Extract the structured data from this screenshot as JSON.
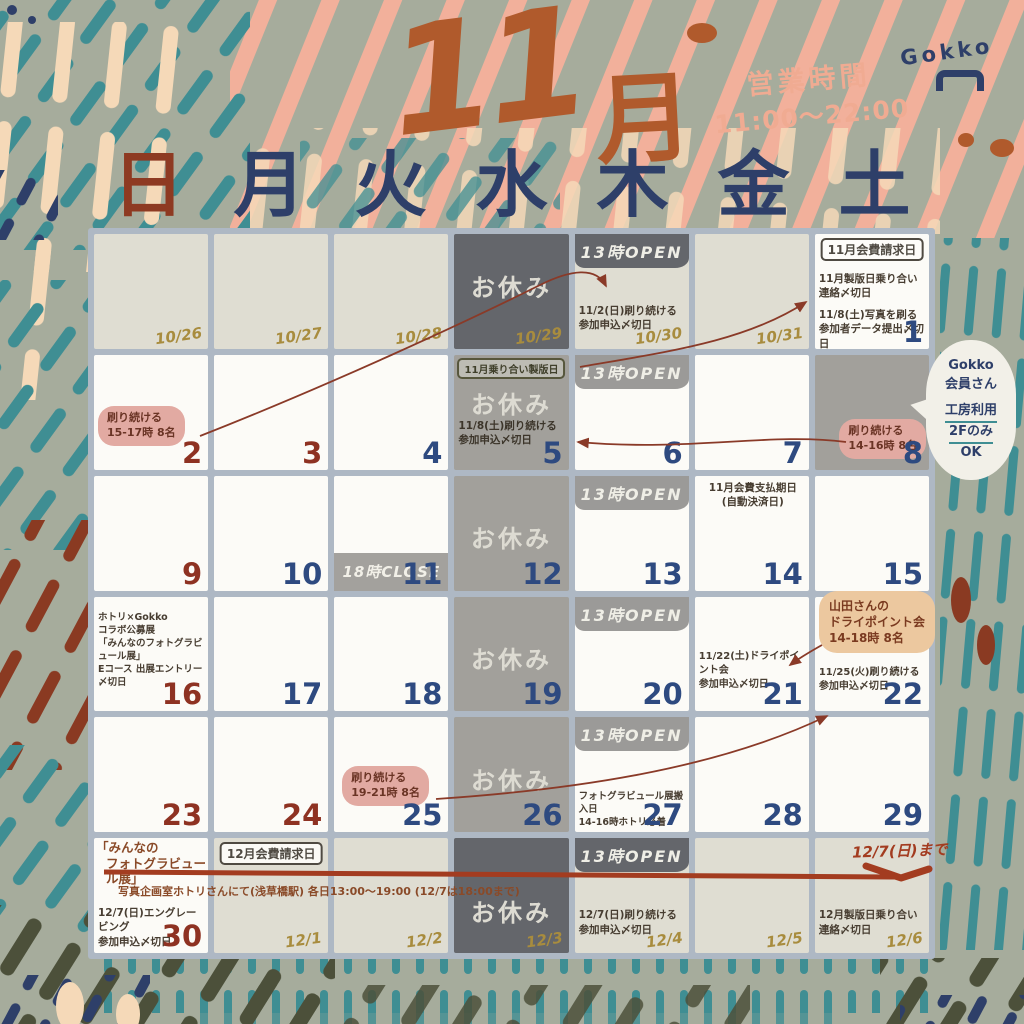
{
  "header": {
    "month_title_num": "11",
    "month_title_unit": "月",
    "hours_label": "営業時間",
    "hours_value": "11:00〜22:00",
    "logo_text": "Gokko"
  },
  "weekdays": [
    "日",
    "月",
    "火",
    "水",
    "木",
    "金",
    "土"
  ],
  "speech_bubble": {
    "lines": [
      "Gokko",
      "会員さん",
      "工房利用",
      "2Fのみ",
      "OK"
    ]
  },
  "exhibition": {
    "venue_note": "写真企画室ホトリさんにて(浅草橋駅) 各日13:00〜19:00 (12/7は18:00まで)",
    "until_label": "12/7(日)まで"
  },
  "colors": {
    "background": "#a6ac9c",
    "title_rust": "#b05a2c",
    "navy": "#2e3f69",
    "holiday_red": "#8e3a22",
    "teal": "#3f8e93",
    "peach": "#f2b09b",
    "cream": "#f5d9b8",
    "olive_date": "#a88c3e",
    "cell_white": "#fcfbf7",
    "cell_beige": "#dfddd2",
    "cell_gray": "#a2a09b",
    "cell_dark": "#64666b",
    "grid_border": "#aeb8c4",
    "bubble_pink": "#e2aaa2",
    "bubble_orange": "#ecc89f",
    "timeline_red": "#a33c20"
  },
  "calendar": {
    "cells": [
      {
        "date": "10/26",
        "num": "olive",
        "bg": "beige"
      },
      {
        "date": "10/27",
        "num": "olive",
        "bg": "beige"
      },
      {
        "date": "10/28",
        "num": "olive",
        "bg": "beige"
      },
      {
        "date": "10/29",
        "num": "olive",
        "bg": "dark",
        "closed": "お休み"
      },
      {
        "date": "10/30",
        "num": "olive",
        "bg": "beige",
        "header": "13時OPEN",
        "header_style": "dark",
        "notes": [
          "11/2(日)刷り続ける",
          "参加申込〆切日"
        ]
      },
      {
        "date": "10/31",
        "num": "olive",
        "bg": "beige"
      },
      {
        "date": "1",
        "num": "navy",
        "bg": "white",
        "box": "11月会費請求日",
        "notes": [
          "11月製版日乗り合い",
          "連絡〆切日",
          "",
          "11/8(土)写真を刷る",
          "参加者データ提出〆切日"
        ]
      },
      {
        "date": "2",
        "num": "red",
        "bg": "white",
        "bubble": {
          "style": "pink",
          "lines": [
            "刷り続ける",
            "15-17時 8名"
          ]
        }
      },
      {
        "date": "3",
        "num": "red",
        "bg": "white"
      },
      {
        "date": "4",
        "num": "navy",
        "bg": "white"
      },
      {
        "date": "5",
        "num": "navy",
        "bg": "gray",
        "box": "11月乗り合い製版日",
        "closed": "お休み",
        "notes": [
          "11/8(土)刷り続ける",
          "参加申込〆切日"
        ]
      },
      {
        "date": "6",
        "num": "navy",
        "bg": "white",
        "header": "13時OPEN",
        "header_style": "gray"
      },
      {
        "date": "7",
        "num": "navy",
        "bg": "white"
      },
      {
        "date": "8",
        "num": "navy",
        "bg": "gray",
        "bubble": {
          "style": "pink",
          "lines": [
            "刷り続ける",
            "14-16時 8名"
          ]
        }
      },
      {
        "date": "9",
        "num": "red",
        "bg": "white"
      },
      {
        "date": "10",
        "num": "navy",
        "bg": "white"
      },
      {
        "date": "11",
        "num": "navy",
        "bg": "white",
        "footer": "18時CLOSE"
      },
      {
        "date": "12",
        "num": "navy",
        "bg": "gray",
        "closed": "お休み"
      },
      {
        "date": "13",
        "num": "navy",
        "bg": "white",
        "header": "13時OPEN",
        "header_style": "gray"
      },
      {
        "date": "14",
        "num": "navy",
        "bg": "white",
        "notes": [
          "11月会費支払期日",
          "(自動決済日)"
        ]
      },
      {
        "date": "15",
        "num": "navy",
        "bg": "white"
      },
      {
        "date": "16",
        "num": "red",
        "bg": "white",
        "notes": [
          "ホトリ×Gokko",
          "コラボ公募展",
          "「みんなのフォトグラビュール展」",
          "Eコース 出展エントリー〆切日"
        ]
      },
      {
        "date": "17",
        "num": "navy",
        "bg": "white"
      },
      {
        "date": "18",
        "num": "navy",
        "bg": "white"
      },
      {
        "date": "19",
        "num": "navy",
        "bg": "gray",
        "closed": "お休み"
      },
      {
        "date": "20",
        "num": "navy",
        "bg": "white",
        "header": "13時OPEN",
        "header_style": "gray"
      },
      {
        "date": "21",
        "num": "navy",
        "bg": "white",
        "notes": [
          "11/22(土)ドライポイント会",
          "参加申込〆切日"
        ]
      },
      {
        "date": "22",
        "num": "navy",
        "bg": "white",
        "bubble": {
          "style": "orange",
          "lines": [
            "山田さんの",
            "ドライポイント会",
            "14-18時 8名"
          ]
        },
        "notes": [
          "11/25(火)刷り続ける",
          "参加申込〆切日"
        ]
      },
      {
        "date": "23",
        "num": "red",
        "bg": "white"
      },
      {
        "date": "24",
        "num": "red",
        "bg": "white"
      },
      {
        "date": "25",
        "num": "navy",
        "bg": "white",
        "bubble": {
          "style": "pink",
          "lines": [
            "刷り続ける",
            "19-21時 8名"
          ]
        }
      },
      {
        "date": "26",
        "num": "navy",
        "bg": "gray",
        "closed": "お休み"
      },
      {
        "date": "27",
        "num": "navy",
        "bg": "white",
        "header": "13時OPEN",
        "header_style": "gray",
        "notes": [
          "フォトグラビュール展搬入日",
          "14-16時ホトリ必着"
        ]
      },
      {
        "date": "28",
        "num": "navy",
        "bg": "white"
      },
      {
        "date": "29",
        "num": "navy",
        "bg": "white"
      },
      {
        "date": "30",
        "num": "red",
        "bg": "white",
        "top_note": [
          "「みんなの",
          "フォトグラビュール展」"
        ],
        "notes": [
          "12/7(日)エングレービング",
          "参加申込〆切日"
        ]
      },
      {
        "date": "12/1",
        "num": "olive",
        "bg": "beige",
        "box": "12月会費請求日"
      },
      {
        "date": "12/2",
        "num": "olive",
        "bg": "beige"
      },
      {
        "date": "12/3",
        "num": "olive",
        "bg": "dark",
        "closed": "お休み"
      },
      {
        "date": "12/4",
        "num": "olive",
        "bg": "beige",
        "header": "13時OPEN",
        "header_style": "dark",
        "notes": [
          "12/7(日)刷り続ける",
          "参加申込〆切日"
        ]
      },
      {
        "date": "12/5",
        "num": "olive",
        "bg": "beige"
      },
      {
        "date": "12/6",
        "num": "olive",
        "bg": "beige",
        "notes": [
          "12月製版日乗り合い",
          "連絡〆切日"
        ]
      }
    ]
  }
}
